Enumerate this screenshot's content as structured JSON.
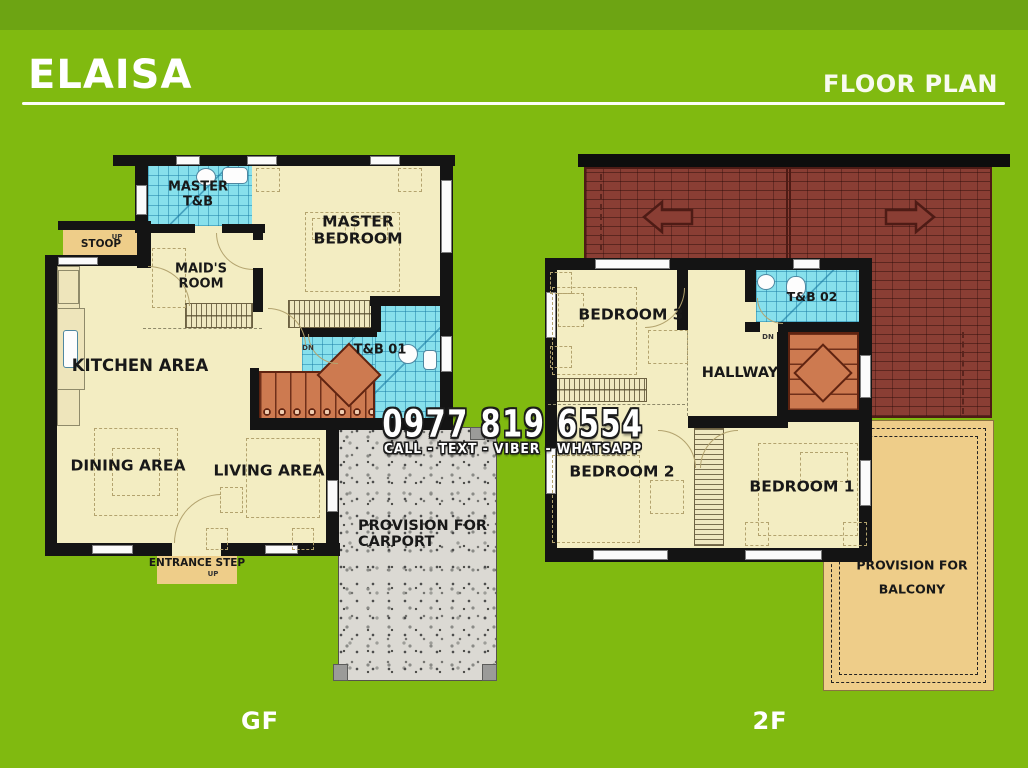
{
  "header": {
    "title": "ELAISA",
    "subtitle": "FLOOR PLAN"
  },
  "contact": {
    "phone": "0977 819 6554",
    "channels": "CALL - TEXT - VIBER - WHATSAPP"
  },
  "markers": {
    "up": "UP",
    "dn": "DN"
  },
  "floors": {
    "gf": {
      "tag": "GF",
      "rooms": {
        "master_tb": {
          "line1": "MASTER",
          "line2": "T&B"
        },
        "master_bedroom": {
          "line1": "MASTER",
          "line2": "BEDROOM"
        },
        "maids_room": {
          "line1": "MAID'S",
          "line2": "ROOM"
        },
        "stoop": "STOOP",
        "kitchen": "KITCHEN AREA",
        "tb01": "T&B 01",
        "dining": "DINING AREA",
        "living": "LIVING AREA",
        "carport": {
          "line1": "PROVISION FOR",
          "line2": "CARPORT"
        },
        "entrance_step": "ENTRANCE STEP"
      }
    },
    "sf": {
      "tag": "2F",
      "rooms": {
        "bedroom3": "BEDROOM 3",
        "tb02": "T&B 02",
        "hallway": "HALLWAY",
        "bedroom2": "BEDROOM 2",
        "bedroom1": "BEDROOM 1",
        "balcony": {
          "line1": "PROVISION FOR",
          "line2": "BALCONY"
        }
      }
    }
  },
  "colors": {
    "background": "#80ba10",
    "floor": "#f3edc2",
    "tile": "#87e0ec",
    "stairs": "#cd7a50",
    "roof": "#8a3e34",
    "accent_tan": "#eecd89",
    "wall": "#141414",
    "granite": "#dbd9d3"
  }
}
